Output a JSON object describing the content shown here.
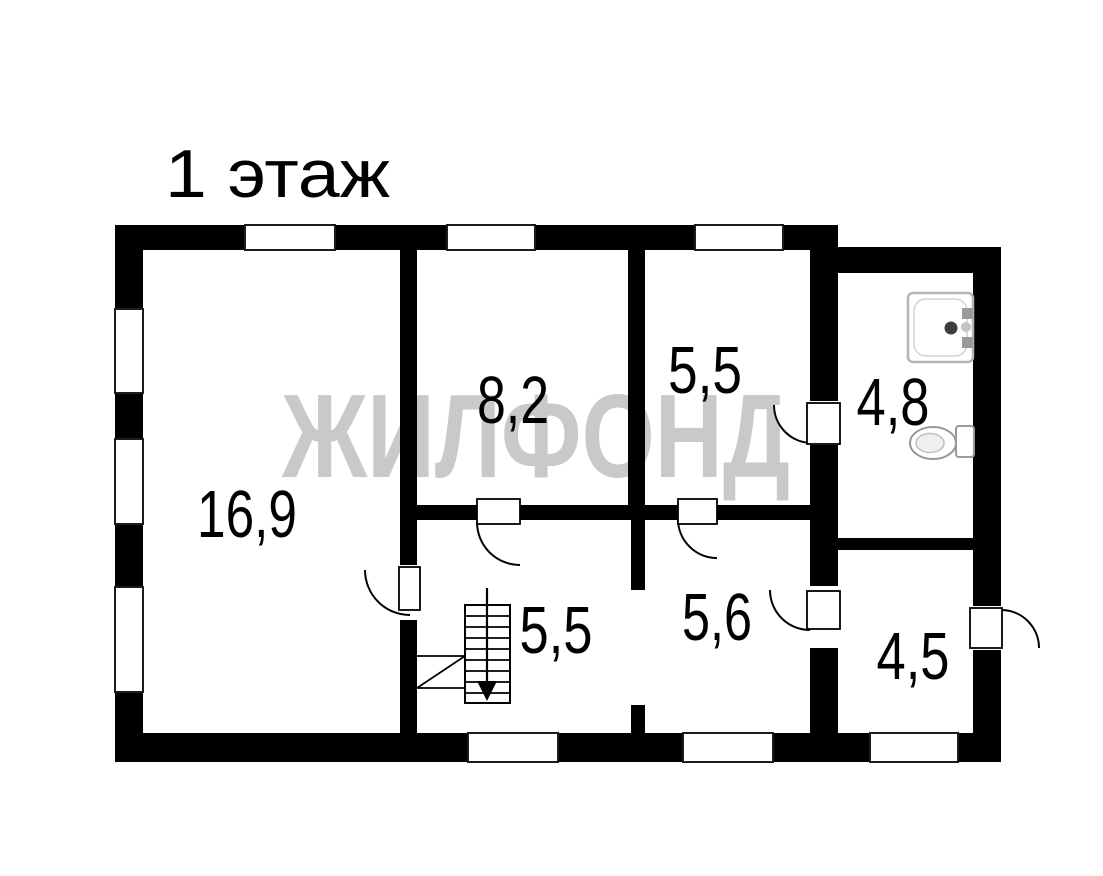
{
  "floor_plan": {
    "title": "1 этаж",
    "watermark": "ЖИЛФОНД",
    "rooms": [
      {
        "id": "living-room",
        "area": "16,9"
      },
      {
        "id": "room-top-middle",
        "area": "8,2"
      },
      {
        "id": "room-top-right",
        "area": "5,5"
      },
      {
        "id": "bathroom",
        "area": "4,8"
      },
      {
        "id": "stair-hall",
        "area": "5,5"
      },
      {
        "id": "room-bottom-middle",
        "area": "5,6"
      },
      {
        "id": "entry-room",
        "area": "4,5"
      }
    ],
    "fixtures": [
      "stairs-icon",
      "shower-tray-icon",
      "toilet-icon"
    ],
    "colors": {
      "wall": "#000000",
      "floor": "#ffffff",
      "watermark": "#c9c9c9",
      "fixture_outline": "#9a9a9a"
    }
  }
}
